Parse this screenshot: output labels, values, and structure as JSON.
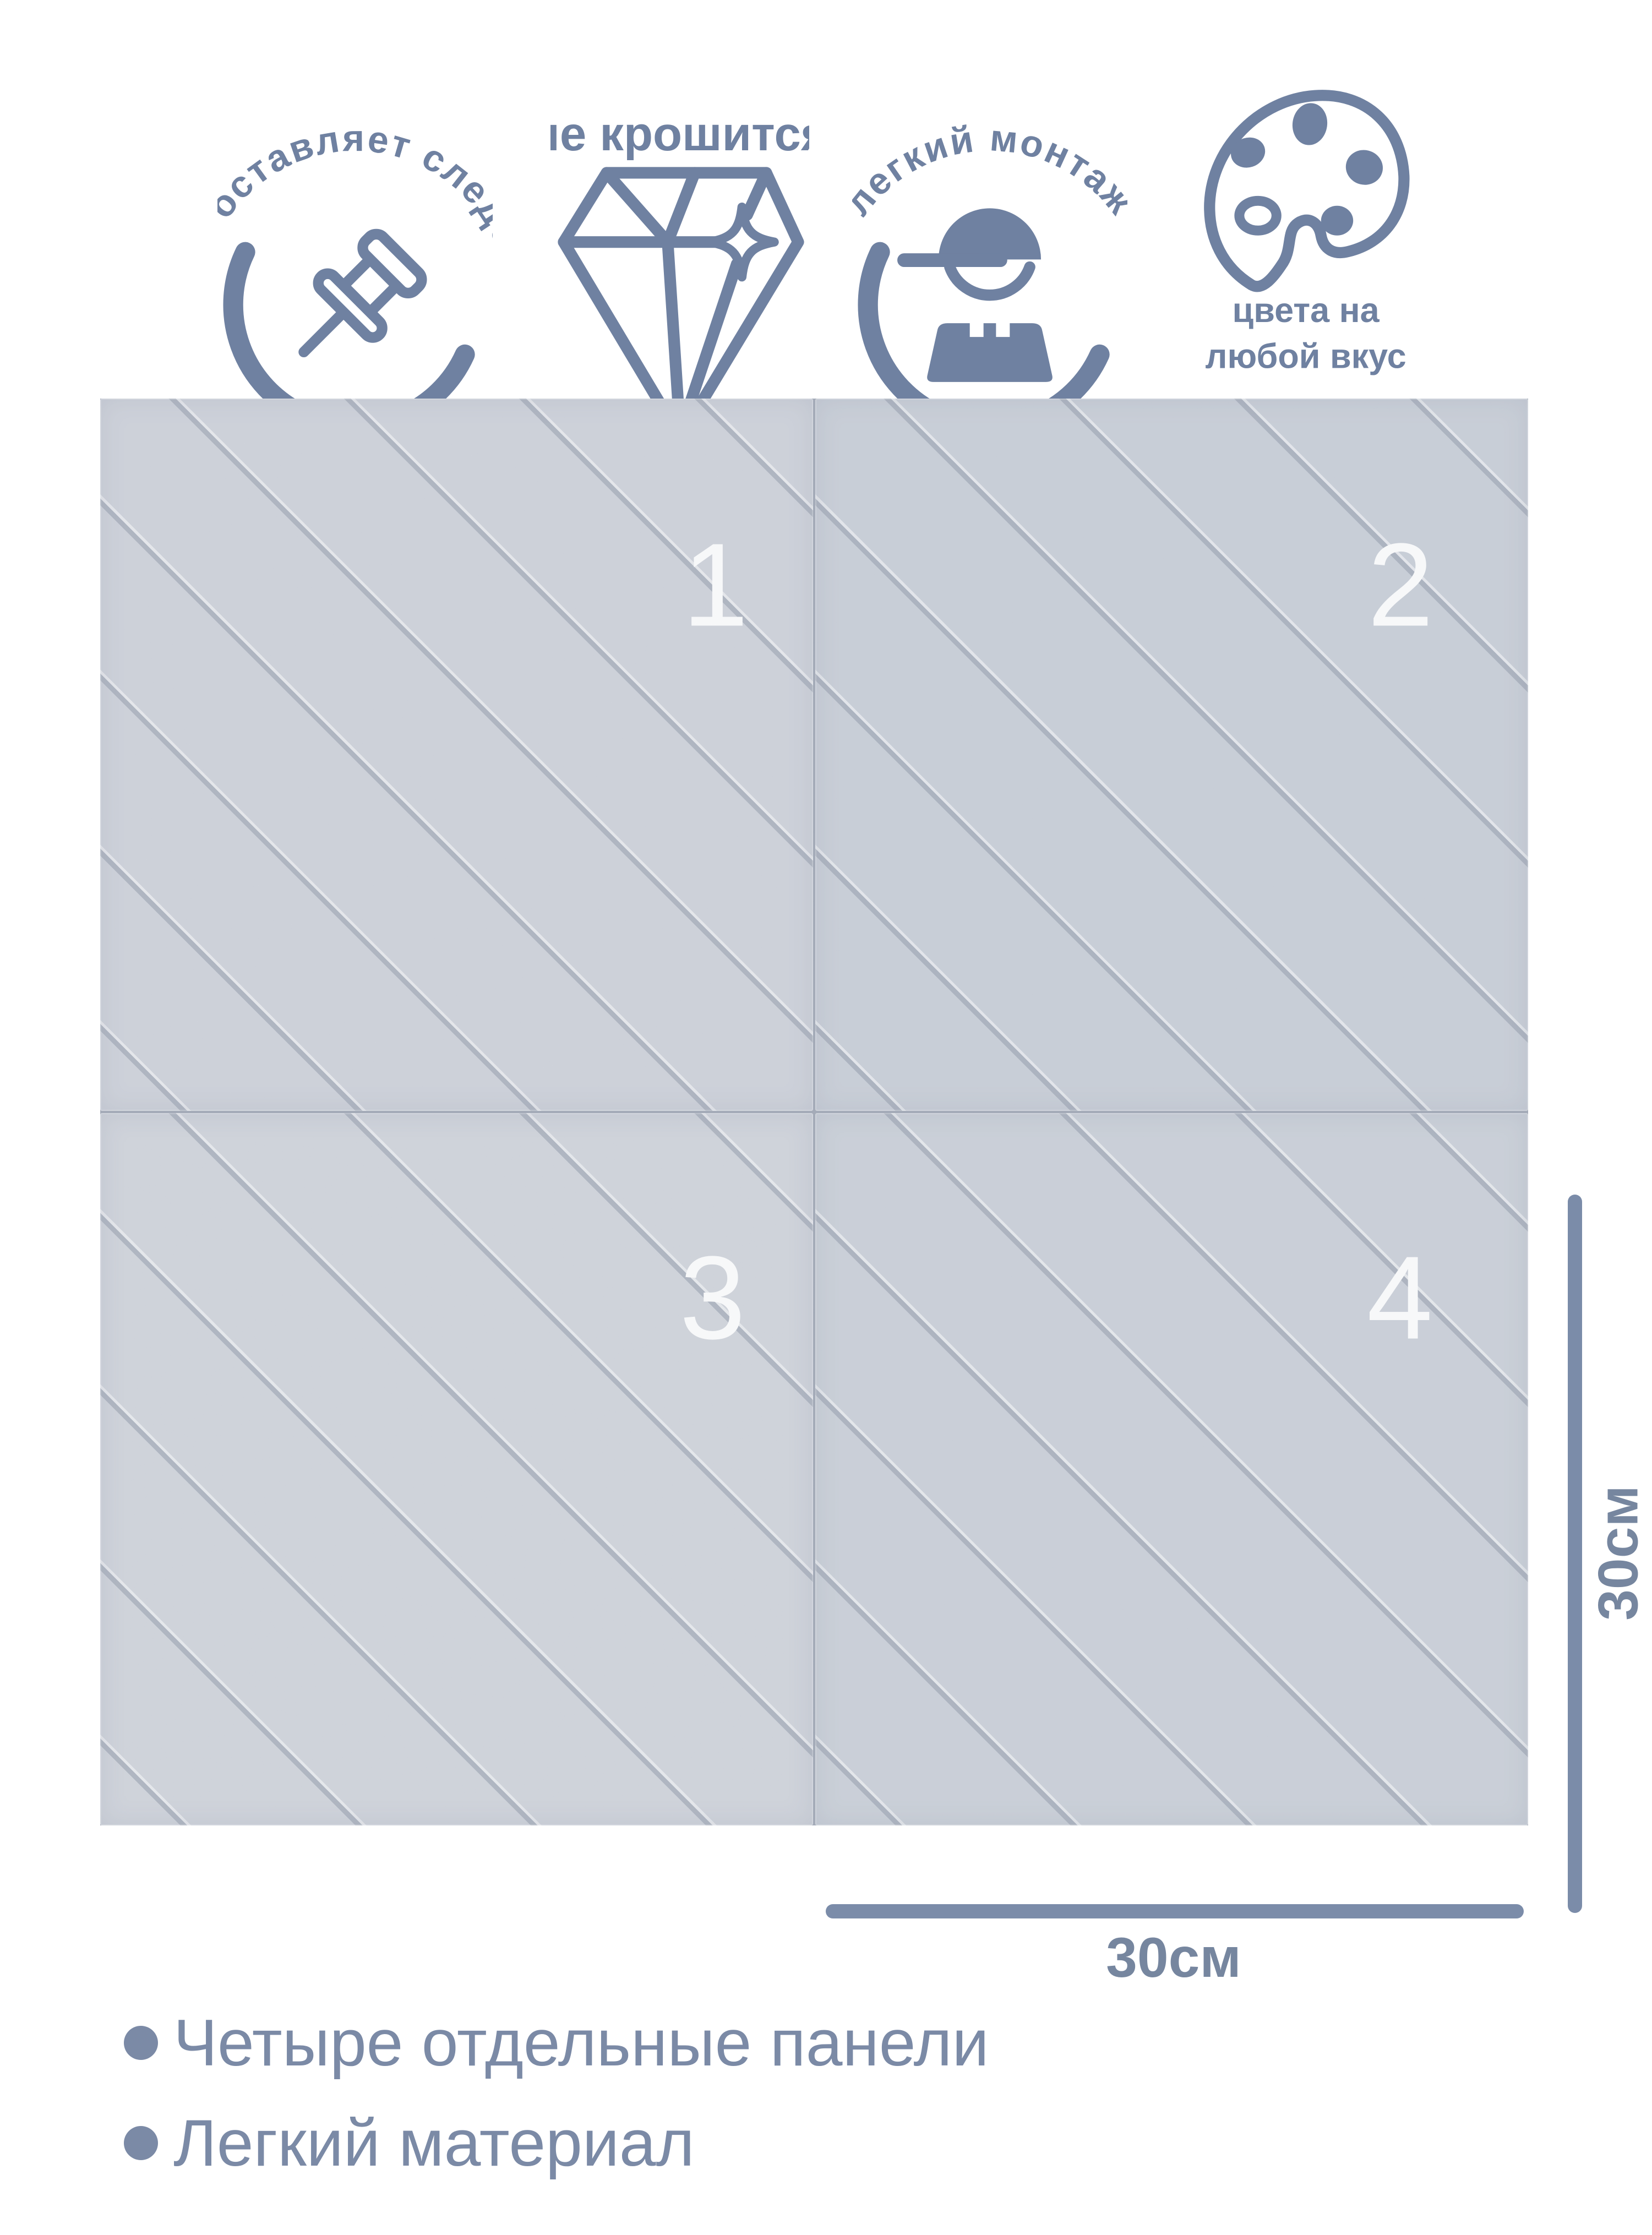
{
  "colors": {
    "accent_slate": "#6f81a1",
    "bullet_text": "#7b8aa6",
    "dimension_bar": "#7b8ca9",
    "dimension_label": "#76869f",
    "panel_base_1": "#c9cdd6",
    "panel_base_2": "#c3c9d3",
    "panel_base_3": "#cbcfd7",
    "panel_base_4": "#c5cbd4",
    "panel_groove": "#aeb6c3",
    "panel_number": "#ffffff"
  },
  "features": [
    {
      "icon": "pushpin-icon",
      "label": "не оставляет следов",
      "layout": "curved-around-circle"
    },
    {
      "icon": "diamond-icon",
      "label": "не крошится",
      "layout": "text-above"
    },
    {
      "icon": "worker-icon",
      "label": "легкий монтаж",
      "layout": "curved-around-circle"
    },
    {
      "icon": "palette-icon",
      "label": "цвета на любой вкус",
      "line1": "цвета на",
      "line2": "любой вкус",
      "layout": "text-below"
    }
  ],
  "panels": {
    "numbers": [
      "1",
      "2",
      "3",
      "4"
    ]
  },
  "dimensions": {
    "width_label": "30см",
    "height_label": "30см"
  },
  "bullets": {
    "items": [
      {
        "label": "Четыре отдельные панели"
      },
      {
        "label": "Легкий материал"
      }
    ]
  }
}
